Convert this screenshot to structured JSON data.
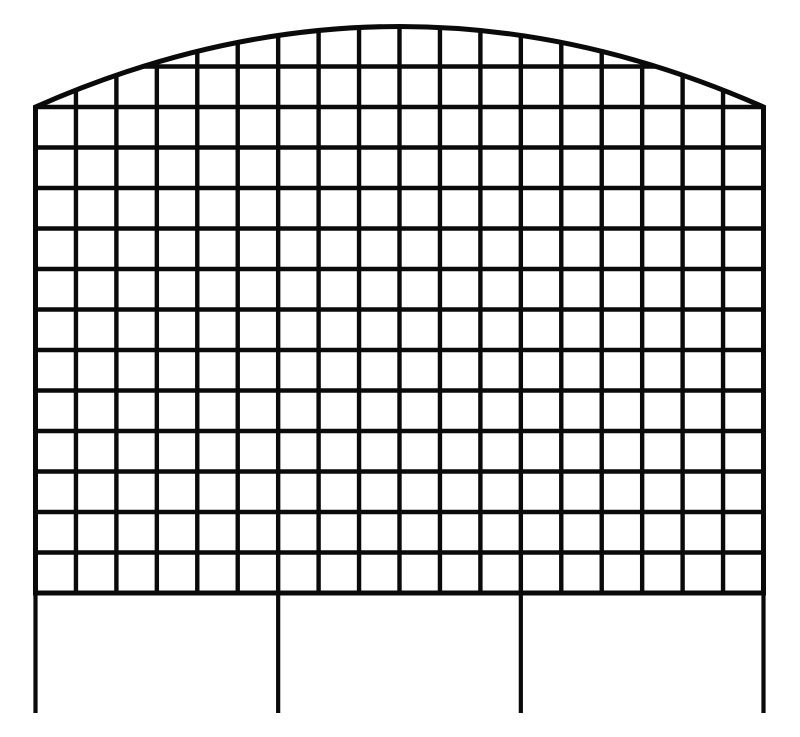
{
  "figure": {
    "name": "arched-wire-grid-garden-fence-panel-drawing",
    "background_color": "#ffffff",
    "stroke_color": "#0a0a0a",
    "canvas": {
      "width": 800,
      "height": 737
    },
    "panel": {
      "left_x": 35.5,
      "right_x": 763.5,
      "side_top_y": 107,
      "bottom_rail_y": 593,
      "arch_peak_y": 26.5,
      "columns": 18,
      "rows_below_arch": 12,
      "horizontal_line_count": 14,
      "grid_line_width": 4.4,
      "outline_width": 5
    },
    "legs": {
      "column_indices": [
        0,
        6,
        12,
        18
      ],
      "tip_y": 713,
      "line_width": 4.2
    }
  }
}
